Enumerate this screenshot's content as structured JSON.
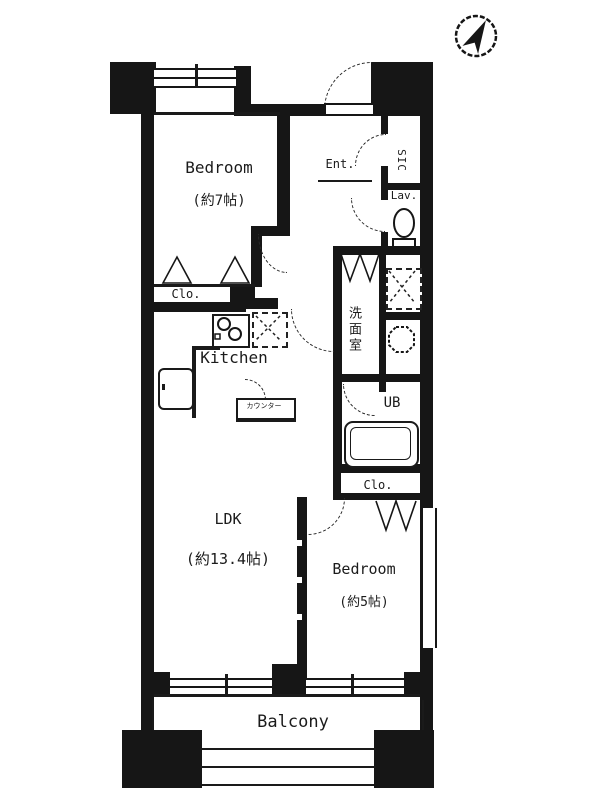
{
  "plan_title": "1LDK apartment floor plan",
  "compass": {
    "direction": "north-east"
  },
  "rooms": {
    "bedroom_top": {
      "name": "Bedroom",
      "size": "(約7帖)"
    },
    "bedroom_right": {
      "name": "Bedroom",
      "size": "(約5帖)"
    },
    "ldk": {
      "name": "LDK",
      "size": "(約13.4帖)"
    },
    "kitchen": {
      "name": "Kitchen"
    },
    "balcony": {
      "name": "Balcony"
    },
    "entrance": {
      "name": "Ent."
    },
    "shoe_closet": {
      "name": "SIC"
    },
    "lavatory": {
      "name": "Lav."
    },
    "washroom": {
      "name": "洗面室"
    },
    "unit_bath": {
      "name": "UB"
    },
    "closet_top": {
      "name": "Clo."
    },
    "closet_right": {
      "name": "Clo."
    },
    "counter": {
      "name": "カウンター"
    }
  },
  "colors": {
    "wall": "#161616",
    "background": "#ffffff",
    "line": "#222222"
  }
}
